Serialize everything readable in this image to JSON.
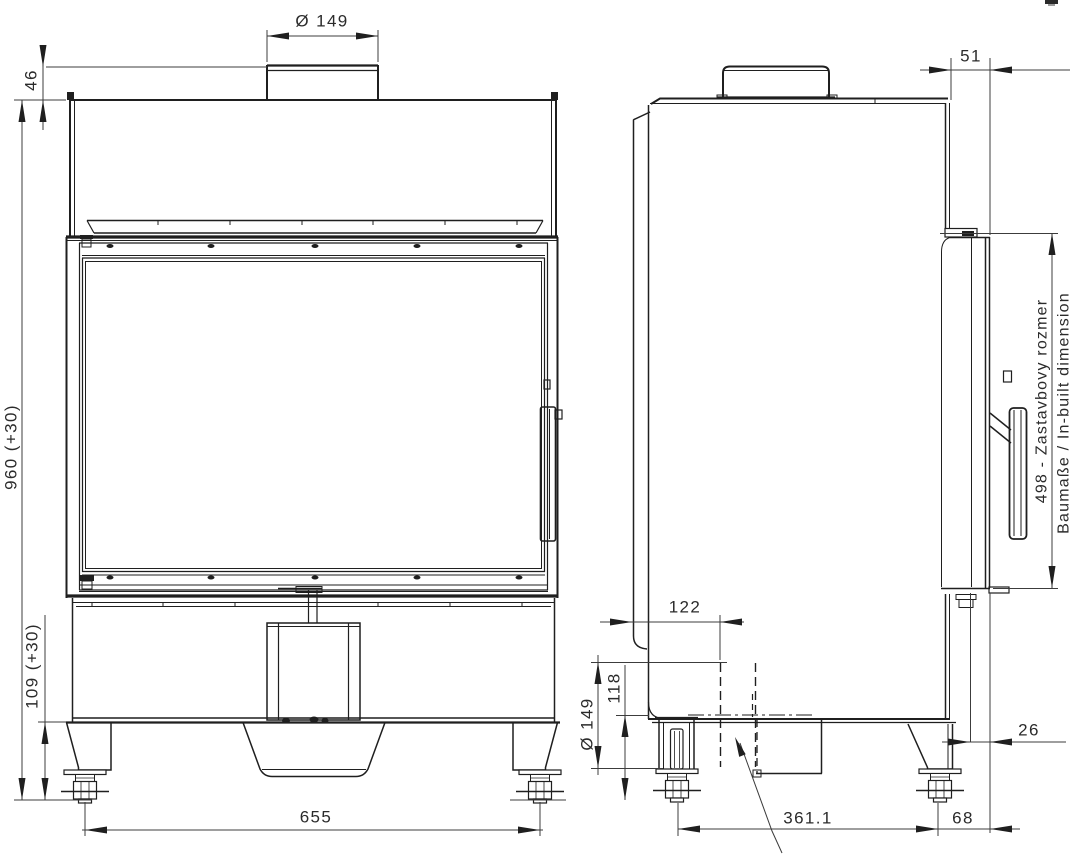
{
  "drawing": {
    "type": "fireplace-insert-dimension-drawing",
    "colors": {
      "line": "#1f1f1f",
      "dimension": "#3c3c3c",
      "background": "#ffffff"
    },
    "dims": {
      "front_flue_diameter": "Ø 149",
      "collar_height": "46",
      "overall_height": "960 (+30)",
      "plinth_height": "109 (+30)",
      "overall_width": "655",
      "frame_projection": "51",
      "inbuilt_height_sk": "498 - Zastavbovy rozmer",
      "inbuilt_height_de_en": "Baumaße / In-built dimension",
      "rear_outlet_offset": "122",
      "outlet_clearance": "118",
      "rear_flue_diameter": "Ø 149",
      "foot_spacing": "361.1",
      "rear_foot_to_back": "68",
      "glass_recess": "26"
    }
  }
}
